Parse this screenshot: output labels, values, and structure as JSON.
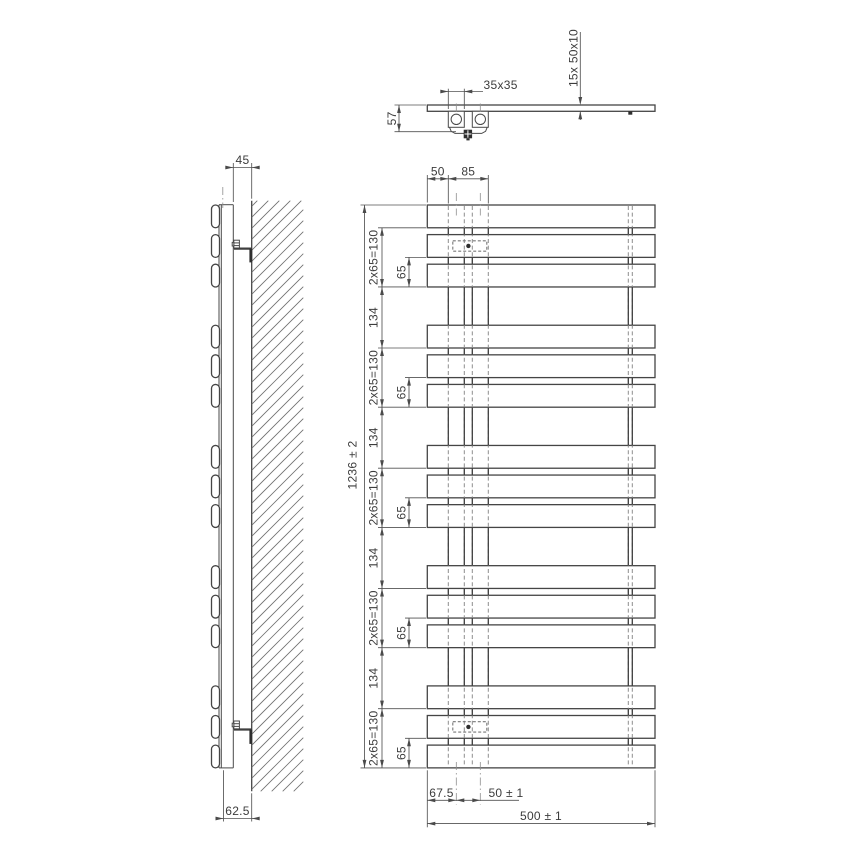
{
  "front_view": {
    "top_dim_left": "50",
    "top_dim_right": "85",
    "overall_height": "1236 ± 2",
    "group_dim": "2x65=130",
    "bar_spacing_dim": "65",
    "group_gap_dim": "134",
    "bottom_edge_offset": "67.5",
    "bottom_axis_spacing": "50 ± 1",
    "overall_width": "500 ± 1",
    "bar_groups": 5,
    "bars_per_group": 3
  },
  "side_view": {
    "wall_clearance": "45",
    "bottom_wall_distance": "62.5"
  },
  "top_view": {
    "tube_section": "35x35",
    "bracket_depth": "57",
    "bar_profile": "15x  50x10"
  },
  "colors": {
    "background": "#ffffff",
    "object_line": "#454545",
    "dimension_line": "#525252",
    "hidden_line": "#8e8e8e",
    "text": "#3c3c3c"
  }
}
